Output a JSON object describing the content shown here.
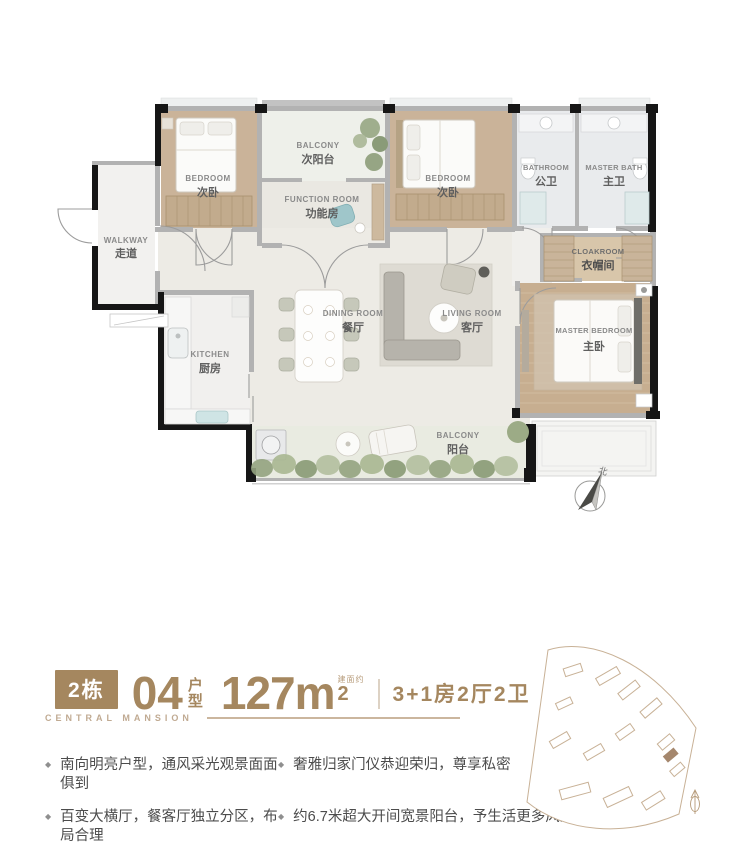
{
  "colors": {
    "accent_brown": "#a5875f",
    "brand_text": "#c0aa92",
    "wall_black": "#161616",
    "wall_gray": "#b2b2b2",
    "wood_floor": "#cab399",
    "greenery": "#9aab86",
    "site_outline": "#c8b196",
    "site_highlight": "#a5876d"
  },
  "floor_plan": {
    "rooms": [
      {
        "id": "walkway",
        "en": "WALKWAY",
        "cn": "走道"
      },
      {
        "id": "bedroom-a",
        "en": "BEDROOM",
        "cn": "次卧"
      },
      {
        "id": "balcony-north",
        "en": "BALCONY",
        "cn": "次阳台"
      },
      {
        "id": "function-room",
        "en": "FUNCTION ROOM",
        "cn": "功能房"
      },
      {
        "id": "bedroom-b",
        "en": "BEDROOM",
        "cn": "次卧"
      },
      {
        "id": "bathroom",
        "en": "BATHROOM",
        "cn": "公卫"
      },
      {
        "id": "master-bath",
        "en": "MASTER BATH",
        "cn": "主卫"
      },
      {
        "id": "cloakroom",
        "en": "CLOAKROOM",
        "cn": "衣帽间"
      },
      {
        "id": "kitchen",
        "en": "KITCHEN",
        "cn": "厨房"
      },
      {
        "id": "dining-room",
        "en": "DINING ROOM",
        "cn": "餐厅"
      },
      {
        "id": "living-room",
        "en": "LIVING ROOM",
        "cn": "客厅"
      },
      {
        "id": "master-bedroom",
        "en": "MASTER BEDROOM",
        "cn": "主卧"
      },
      {
        "id": "balcony-south",
        "en": "BALCONY",
        "cn": "阳台"
      }
    ],
    "compass_label": "北"
  },
  "info": {
    "building": "2栋",
    "unit_number": "04",
    "unit_type_label": "户型",
    "area_number": "127m",
    "area_superscript": "2",
    "area_note": "建面约",
    "layout": "3+1房2厅2卫",
    "brand": "CENTRAL MANSION"
  },
  "features": [
    "南向明亮户型，通风采光观景面面俱到",
    "奢雅归家门仪恭迎荣归，尊享私密",
    "百变大横厅，餐客厅独立分区，布局合理",
    "约6.7米超大开间宽景阳台，予生活更多风景"
  ]
}
